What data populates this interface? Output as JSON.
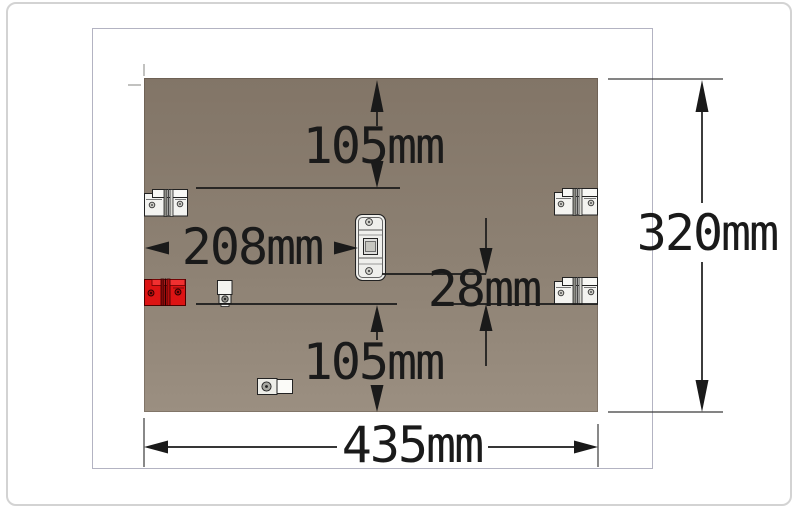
{
  "drawing": {
    "kind": "dimensioned panel drawing (top view)",
    "dimensions": {
      "top_offset": "105mm",
      "latch_from_left": "208mm",
      "hinge_gap": "28mm",
      "bottom_offset": "105mm",
      "panel_width": "435mm",
      "panel_height": "320mm"
    },
    "components": [
      "hinge-top-left",
      "hinge-top-right",
      "hinge-mid-right",
      "red-connector",
      "center-latch",
      "small-bracket",
      "bottom-bracket"
    ],
    "colors": {
      "panel_top": "#827567",
      "panel_bottom": "#9b8f81",
      "ink": "#1a1a1a",
      "red_connector": "#dd1414",
      "frame_border": "#d3d3d3",
      "sheet_border": "#b3b3c2"
    }
  }
}
